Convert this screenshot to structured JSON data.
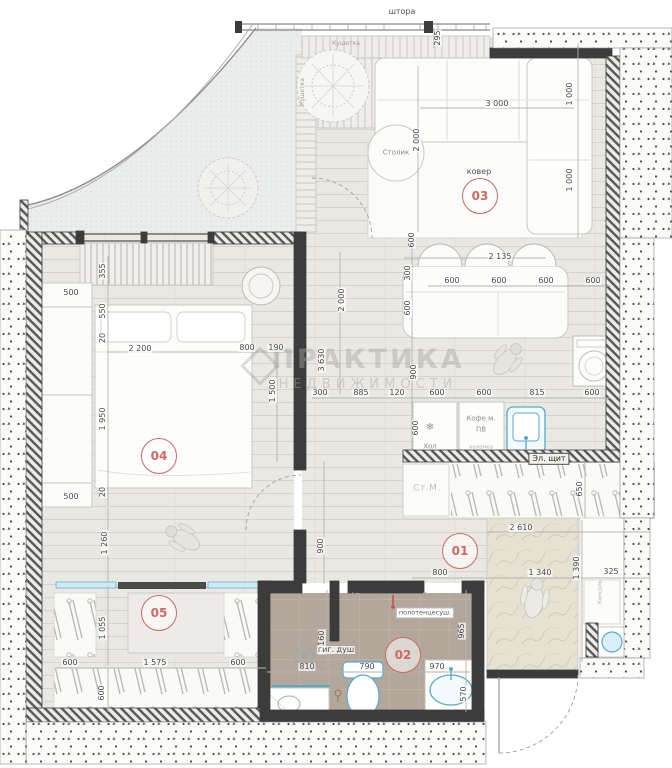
{
  "watermark": {
    "line1": "ПРАКТИКА",
    "line2": "НЕДВИЖИМОСТИ"
  },
  "colors": {
    "accent_red": "#cb6a61",
    "blue": "#58aacb",
    "wall_dark": "#3c3c3c",
    "wood_floor": "#eae8e3",
    "marble_floor": "#e5e2d1",
    "bath_floor": "#b3a79c",
    "dim_text": "#4a4a4a"
  },
  "room_markers": [
    {
      "num": "01",
      "x": 460,
      "y": 551
    },
    {
      "num": "02",
      "x": 403,
      "y": 655
    },
    {
      "num": "03",
      "x": 480,
      "y": 196
    },
    {
      "num": "04",
      "x": 159,
      "y": 456
    },
    {
      "num": "05",
      "x": 159,
      "y": 613
    }
  ],
  "annotations": [
    {
      "name": "curtain-label",
      "text": "штора",
      "x": 402,
      "y": 12,
      "cls": "ann-dark"
    },
    {
      "name": "daybed-label",
      "text": "Кушетка",
      "x": 346,
      "y": 44,
      "cls": "ann-tiny"
    },
    {
      "name": "bench-label",
      "text": "Кушетка",
      "x": 303,
      "y": 92,
      "cls": "ann-tiny",
      "rot": 1
    },
    {
      "name": "coffee-table-label",
      "text": "Столик",
      "x": 396,
      "y": 153,
      "cls": "ann-gray"
    },
    {
      "name": "rug-label",
      "text": "ковер",
      "x": 479,
      "y": 172,
      "cls": "ann-dark"
    },
    {
      "name": "snowflake-icon",
      "text": "❄",
      "x": 430,
      "y": 428,
      "cls": "ann-snow"
    },
    {
      "name": "fridge-label",
      "text": "Хол",
      "x": 430,
      "y": 447,
      "cls": "ann-gray"
    },
    {
      "name": "coffee-machine-label",
      "text": "Кофе м.",
      "x": 481,
      "y": 419,
      "cls": "ann-gray"
    },
    {
      "name": "coffee-machine-label2",
      "text": "ПВ",
      "x": 481,
      "y": 430,
      "cls": "ann-gray"
    },
    {
      "name": "column-label",
      "text": "колонка",
      "x": 481,
      "y": 448,
      "cls": "ann-micro"
    },
    {
      "name": "electrical-panel-label",
      "text": "Эл. щит",
      "x": 549,
      "y": 459,
      "cls": "ann-box"
    },
    {
      "name": "washing-machine-label",
      "text": "Ст.М.",
      "x": 427,
      "y": 489,
      "cls": "ann-light"
    },
    {
      "name": "console-label",
      "text": "Консоль",
      "x": 601,
      "y": 592,
      "cls": "ann-micro",
      "rot": 1
    },
    {
      "name": "towel-dryer-label",
      "text": "полотенцесуш.",
      "x": 425,
      "y": 613,
      "cls": "ann-boxwhite"
    },
    {
      "name": "hygienic-shower-label",
      "text": "гиг. душ",
      "x": 336,
      "y": 650,
      "cls": "ann-dark"
    }
  ],
  "dimensions": [
    {
      "t": "295",
      "x": 438,
      "y": 38,
      "r": 1
    },
    {
      "t": "3 000",
      "x": 497,
      "y": 104
    },
    {
      "t": "2 000",
      "x": 417,
      "y": 140,
      "r": 1
    },
    {
      "t": "1 000",
      "x": 570,
      "y": 94,
      "r": 1
    },
    {
      "t": "1 000",
      "x": 570,
      "y": 180,
      "r": 1
    },
    {
      "t": "2 135",
      "x": 500,
      "y": 257
    },
    {
      "t": "600",
      "x": 452,
      "y": 281
    },
    {
      "t": "600",
      "x": 499,
      "y": 281
    },
    {
      "t": "600",
      "x": 546,
      "y": 281
    },
    {
      "t": "600",
      "x": 593,
      "y": 281
    },
    {
      "t": "600",
      "x": 412,
      "y": 240,
      "r": 1
    },
    {
      "t": "300",
      "x": 408,
      "y": 273,
      "r": 1
    },
    {
      "t": "600",
      "x": 408,
      "y": 308,
      "r": 1
    },
    {
      "t": "900",
      "x": 414,
      "y": 372,
      "r": 1
    },
    {
      "t": "300",
      "x": 320,
      "y": 393
    },
    {
      "t": "885",
      "x": 361,
      "y": 393
    },
    {
      "t": "120",
      "x": 397,
      "y": 393
    },
    {
      "t": "600",
      "x": 437,
      "y": 393
    },
    {
      "t": "600",
      "x": 484,
      "y": 393
    },
    {
      "t": "815",
      "x": 537,
      "y": 393
    },
    {
      "t": "600",
      "x": 592,
      "y": 393
    },
    {
      "t": "2 000",
      "x": 342,
      "y": 300,
      "r": 1
    },
    {
      "t": "3 630",
      "x": 322,
      "y": 360,
      "r": 1
    },
    {
      "t": "600",
      "x": 416,
      "y": 428,
      "r": 1
    },
    {
      "t": "900",
      "x": 321,
      "y": 546,
      "r": 1
    },
    {
      "t": "650",
      "x": 580,
      "y": 489,
      "r": 1
    },
    {
      "t": "2 610",
      "x": 521,
      "y": 528
    },
    {
      "t": "800",
      "x": 440,
      "y": 573
    },
    {
      "t": "1 340",
      "x": 540,
      "y": 573
    },
    {
      "t": "1 390",
      "x": 577,
      "y": 568,
      "r": 1
    },
    {
      "t": "325",
      "x": 611,
      "y": 572
    },
    {
      "t": "355",
      "x": 103,
      "y": 271,
      "r": 1
    },
    {
      "t": "500",
      "x": 71,
      "y": 293
    },
    {
      "t": "550",
      "x": 103,
      "y": 311,
      "r": 1
    },
    {
      "t": "20",
      "x": 103,
      "y": 338,
      "r": 1
    },
    {
      "t": "2 200",
      "x": 140,
      "y": 349
    },
    {
      "t": "800",
      "x": 247,
      "y": 348
    },
    {
      "t": "190",
      "x": 276,
      "y": 348
    },
    {
      "t": "1 950",
      "x": 103,
      "y": 419,
      "r": 1
    },
    {
      "t": "1 500",
      "x": 273,
      "y": 391,
      "r": 1
    },
    {
      "t": "20",
      "x": 103,
      "y": 492,
      "r": 1
    },
    {
      "t": "500",
      "x": 71,
      "y": 497
    },
    {
      "t": "1 260",
      "x": 105,
      "y": 543,
      "r": 1
    },
    {
      "t": "1 055",
      "x": 103,
      "y": 628,
      "r": 1
    },
    {
      "t": "600",
      "x": 70,
      "y": 663
    },
    {
      "t": "1 575",
      "x": 155,
      "y": 663
    },
    {
      "t": "600",
      "x": 238,
      "y": 663
    },
    {
      "t": "600",
      "x": 102,
      "y": 693,
      "r": 1
    },
    {
      "t": "1 160",
      "x": 322,
      "y": 642,
      "r": 1
    },
    {
      "t": "810",
      "x": 307,
      "y": 667
    },
    {
      "t": "790",
      "x": 367,
      "y": 667
    },
    {
      "t": "970",
      "x": 437,
      "y": 667
    },
    {
      "t": "570",
      "x": 464,
      "y": 694,
      "r": 1
    },
    {
      "t": "965",
      "x": 462,
      "y": 631,
      "r": 1
    }
  ]
}
